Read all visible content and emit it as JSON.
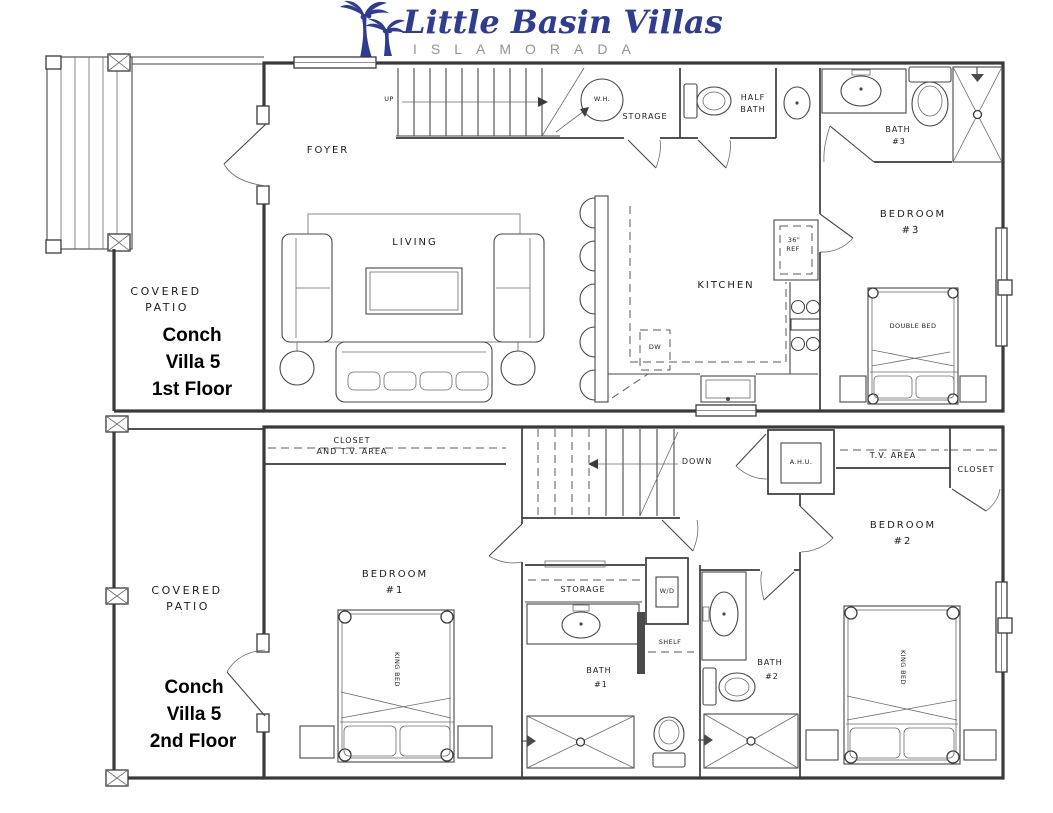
{
  "logo": {
    "title": "Little Basin Villas",
    "subtitle": "ISLAMORADA",
    "title_color": "#2e3c96",
    "subtitle_color": "#8f939e",
    "icon": "palm-trees-icon"
  },
  "floor1": {
    "patio_label_1": "COVERED",
    "patio_label_2": "PATIO",
    "name_1": "Conch",
    "name_2": "Villa 5",
    "name_3": "1st Floor",
    "foyer": "FOYER",
    "living": "LIVING",
    "kitchen": "KITCHEN",
    "up": "UP",
    "wh": "W.H.",
    "storage": "STORAGE",
    "half_bath_1": "HALF",
    "half_bath_2": "BATH",
    "bath3_1": "BATH",
    "bath3_2": "#3",
    "bedroom3_1": "BEDROOM",
    "bedroom3_2": "#3",
    "double_bed": "DOUBLE BED",
    "ref_1": "36\"",
    "ref_2": "REF",
    "dw": "DW"
  },
  "floor2": {
    "patio_label_1": "COVERED",
    "patio_label_2": "PATIO",
    "name_1": "Conch",
    "name_2": "Villa 5",
    "name_3": "2nd Floor",
    "closet_tv_1": "CLOSET",
    "closet_tv_2": "AND T.V. AREA",
    "down": "DOWN",
    "ahu": "A.H.U.",
    "tv_area": "T.V. AREA",
    "closet": "CLOSET",
    "bedroom1_1": "BEDROOM",
    "bedroom1_2": "#1",
    "king_bed_1": "KING BED",
    "storage": "STORAGE",
    "wd": "W/D",
    "shelf": "SHELF",
    "bath1_1": "BATH",
    "bath1_2": "#1",
    "bath2_1": "BATH",
    "bath2_2": "#2",
    "bedroom2_1": "BEDROOM",
    "bedroom2_2": "#2",
    "king_bed_2": "KING BED"
  }
}
